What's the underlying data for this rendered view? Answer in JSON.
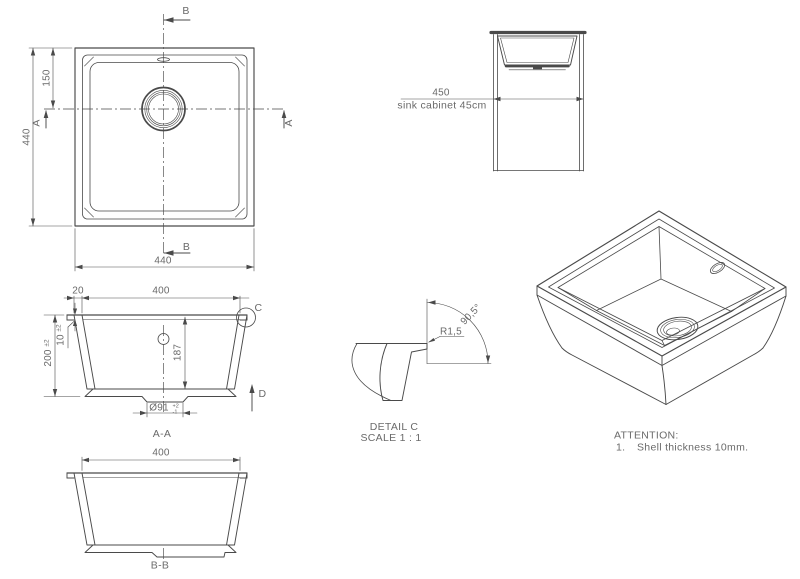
{
  "colors": {
    "line": "#4a4a4a",
    "text": "#6a6a6a",
    "background": "#ffffff"
  },
  "top_view": {
    "dim_left": "440",
    "dim_drain_offset": "150",
    "dim_bottom": "440",
    "marker_a": "A",
    "marker_b": "B"
  },
  "cabinet_view": {
    "dim": "450",
    "caption": "sink cabinet 45cm"
  },
  "section_aa": {
    "label": "A-A",
    "dim_flange": "20",
    "dim_opening": "400",
    "dim_height": "200",
    "dim_height_tol": "±2",
    "dim_lip": "10",
    "dim_lip_tol": "±2",
    "dim_depth": "187",
    "dim_drain_dia": "Ø91",
    "dim_drain_tol_plus": "+2",
    "dim_drain_tol_minus": "-1",
    "marker_c": "C",
    "marker_d": "D"
  },
  "section_bb": {
    "label": "B-B",
    "dim_opening": "400"
  },
  "detail_c": {
    "title": "DETAIL C",
    "scale": "SCALE 1 : 1",
    "radius": "R1,5",
    "angle": "90,5°"
  },
  "notes": {
    "title": "ATTENTION:",
    "item_no": "1.",
    "item_text": "Shell thickness 10mm."
  }
}
